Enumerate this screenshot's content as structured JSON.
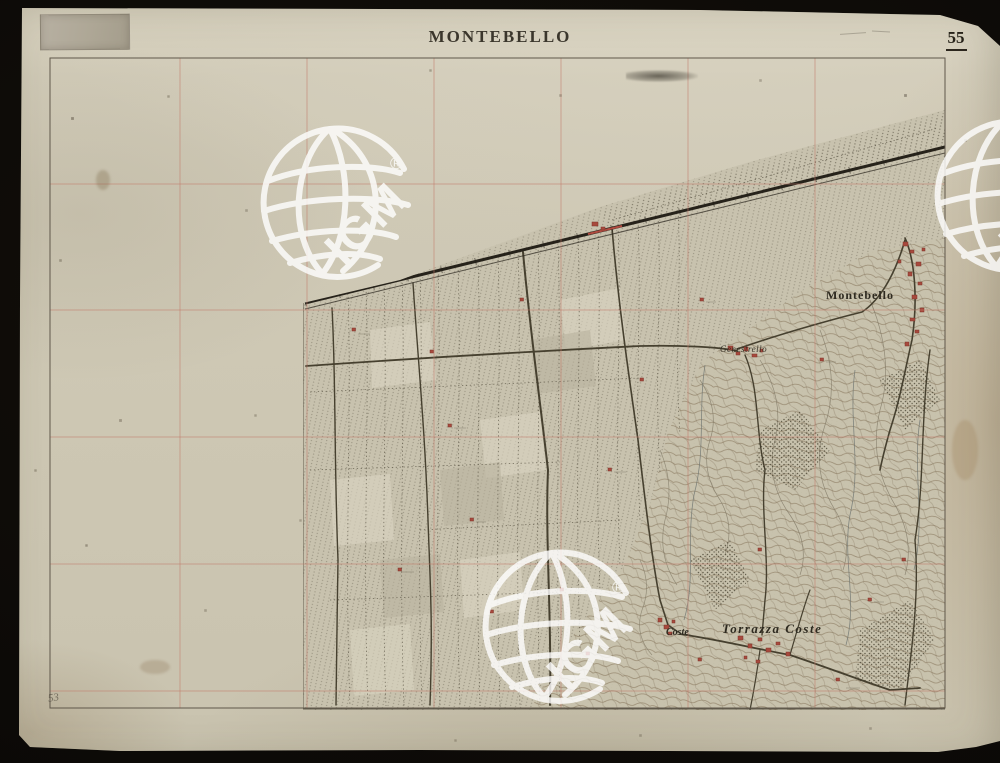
{
  "sheet": {
    "title": "MONTEBELLO",
    "number": "55"
  },
  "map_labels": {
    "montebello": "Montebello",
    "genestrello": "Genestrello",
    "coste": "Coste",
    "torrazza_coste": "Torrazza Coste"
  },
  "watermark": {
    "text": "IGM",
    "registered": "®"
  },
  "annotations": {
    "pencil_number": "53"
  },
  "palette": {
    "background": "#0b0906",
    "paper": "#cfc9b6",
    "title_ink": "#262219",
    "map_ink": "#46402f",
    "contour_brown": "#95866d",
    "building_red": "#a8493d",
    "grid_red": "#c17a6a",
    "watermark_white": "#ffffff"
  }
}
